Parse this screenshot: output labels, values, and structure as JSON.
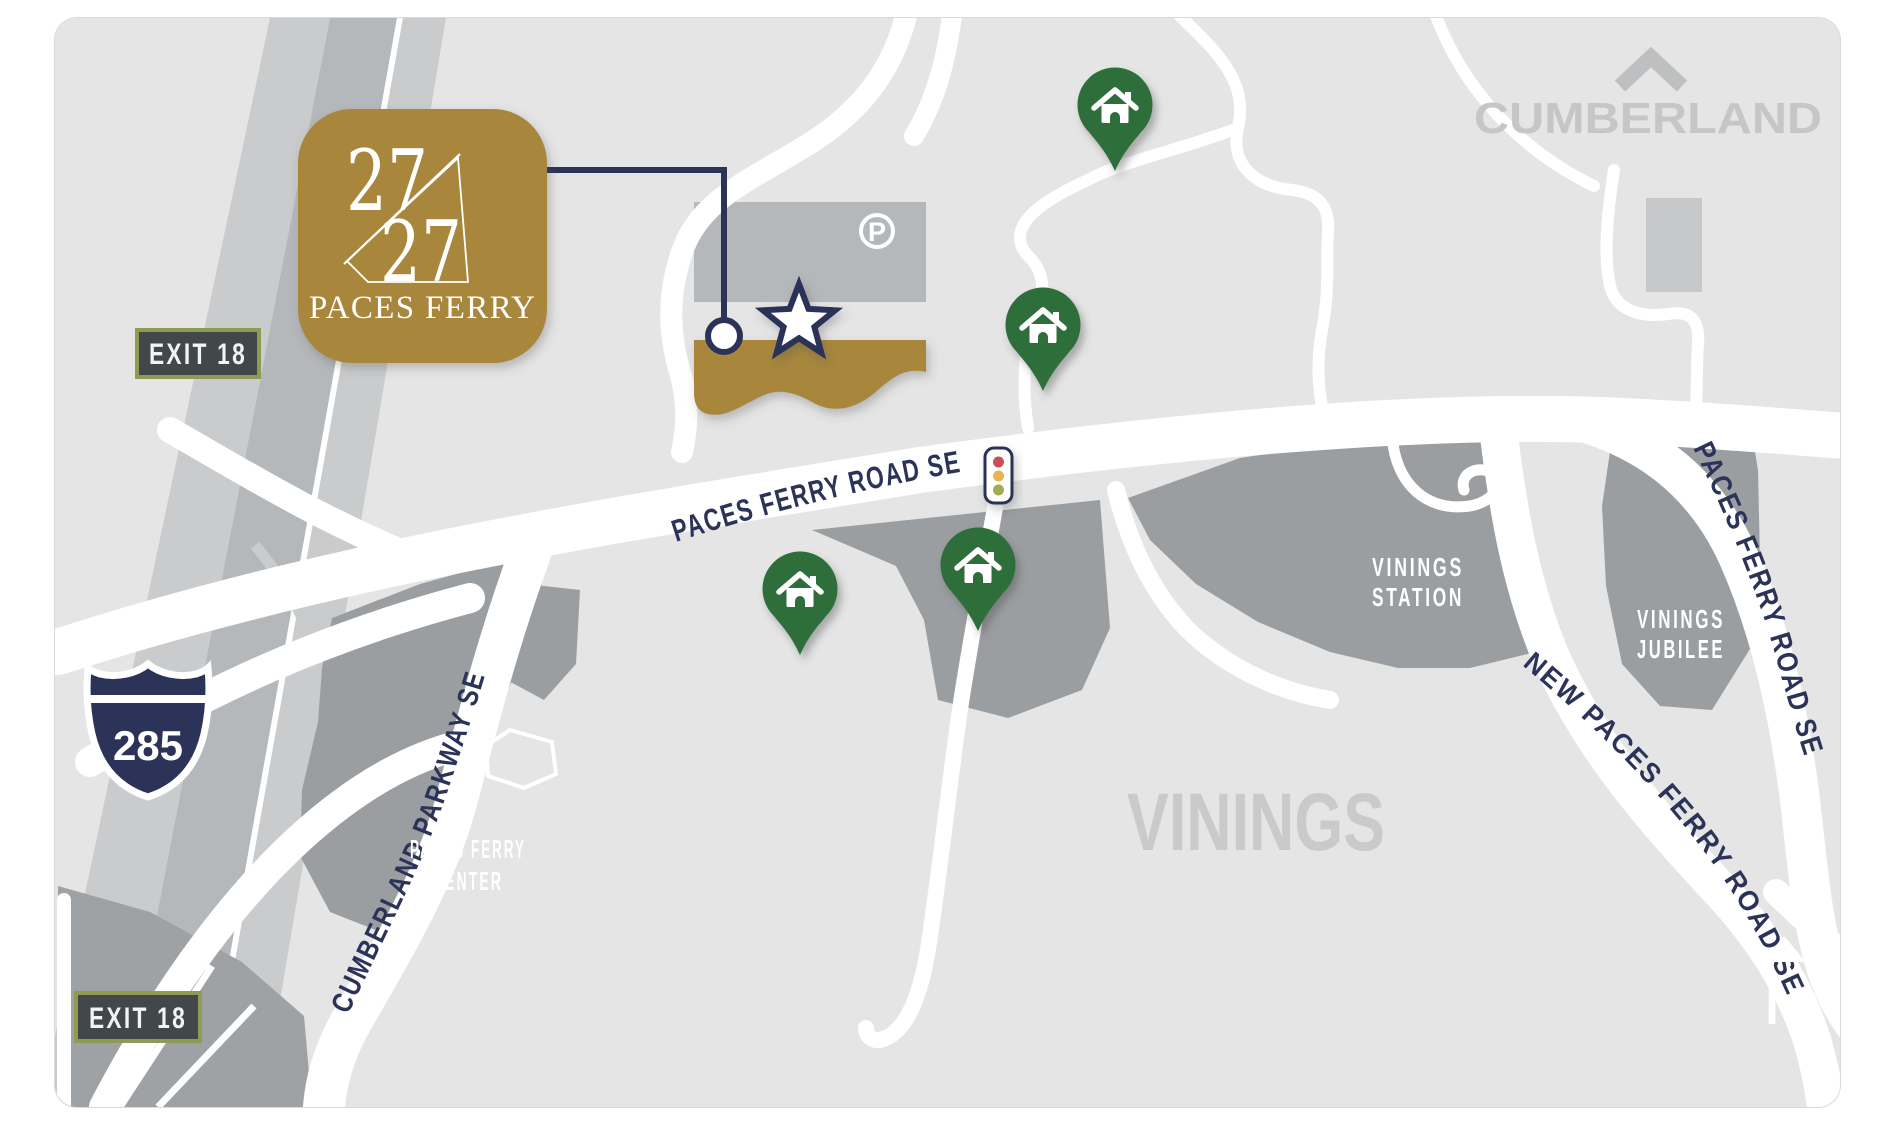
{
  "logo": {
    "number_top": "27",
    "number_bottom": "27",
    "name": "PACES FERRY"
  },
  "labels": {
    "cumberland": "CUMBERLAND",
    "vinings": "VININGS",
    "exit_top": "EXIT 18",
    "exit_bottom": "EXIT 18",
    "interstate": "285",
    "parking": "P",
    "compass": "N"
  },
  "roads": {
    "paces_ferry_main": "PACES FERRY ROAD SE",
    "cumberland_parkway": "CUMBERLAND PARKWAY SE",
    "paces_ferry_right": "PACES FERRY ROAD SE",
    "new_paces_ferry": "NEW PACES FERRY ROAD SE"
  },
  "districts": {
    "vinings_station_line1": "VININGS",
    "vinings_station_line2": "STATION",
    "vinings_jubilee_line1": "VININGS",
    "vinings_jubilee_line2": "JUBILEE",
    "paces_ferry_center_line1": "PACES FERRY",
    "paces_ferry_center_line2": "CENTER"
  },
  "icons": {
    "home_pin": "home-pin",
    "star": "star-location-marker",
    "traffic_light": "traffic-light",
    "parking": "parking-circle",
    "compass_north": "north-arrow",
    "chevron_up": "chevron-up"
  },
  "colors": {
    "gold": "#A8873E",
    "navy": "#2B3359",
    "pin_green": "#2F6E3A",
    "district_gray": "#9B9EA1",
    "map_bg": "#E4E5E4",
    "area_text_gray": "#C6C7C8",
    "exit_border_olive": "#8F9B52",
    "exit_bg": "#42474A",
    "signal_red": "#C94F56",
    "signal_amber": "#E9B54E",
    "signal_green": "#A3AA52"
  }
}
